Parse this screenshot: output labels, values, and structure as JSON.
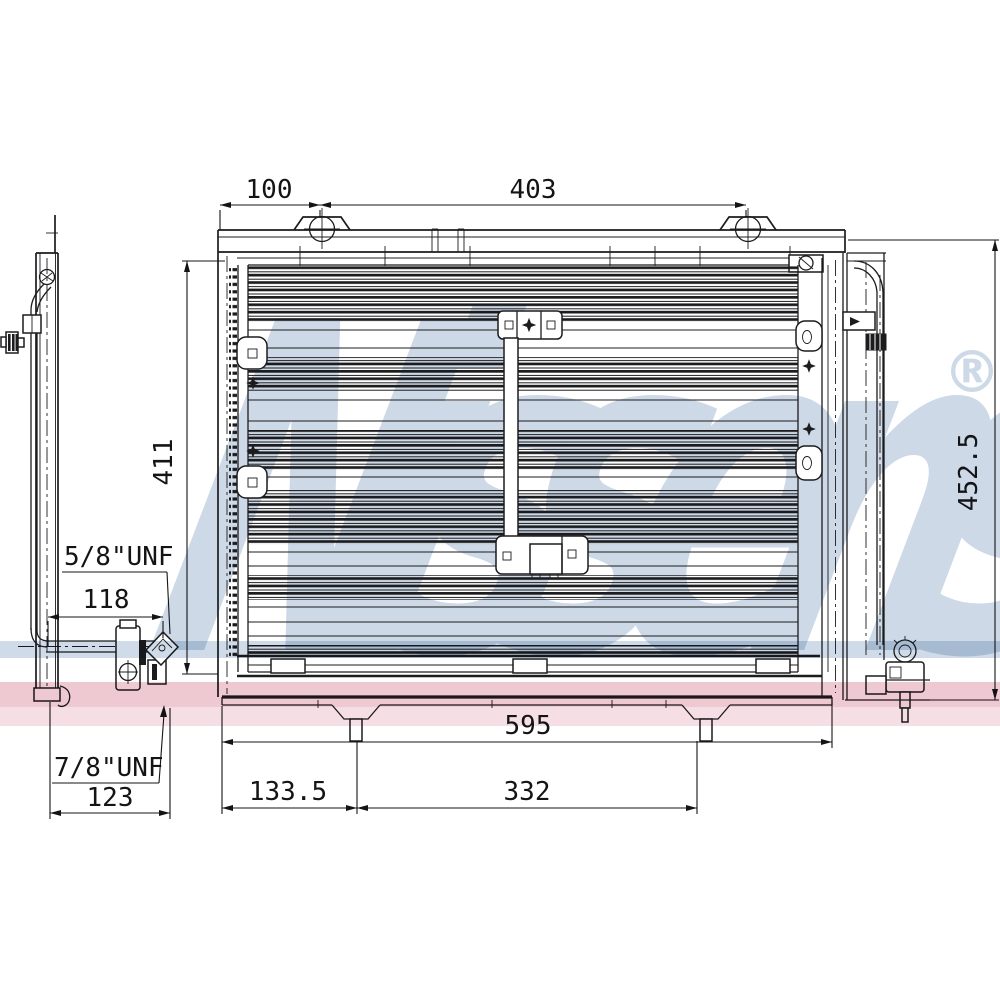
{
  "watermark": {
    "brand": "Nissens",
    "registered": "®"
  },
  "colors": {
    "background": "#ffffff",
    "line": "#1c1c1e",
    "dim_line": "#141416",
    "watermark": "#cdd9e7",
    "band_blue": "#cfdbe8",
    "band_pink": "#eec9d2",
    "band_pink_light": "#f6dfe4"
  },
  "dimensions": {
    "top_offset": "100",
    "top_span": "403",
    "left_height": "411",
    "right_height": "452.5",
    "upper_thread": "5/8\"UNF",
    "upper_offset": "118",
    "lower_thread": "7/8\"UNF",
    "lower_offset": "123",
    "bottom_width": "595",
    "bottom_left": "133.5",
    "bottom_span": "332"
  }
}
